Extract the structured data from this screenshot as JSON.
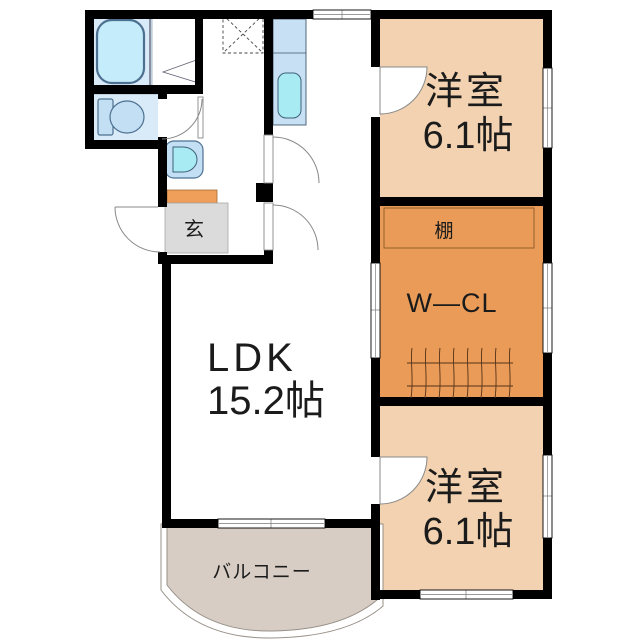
{
  "floorplan": {
    "rooms": {
      "ldk": {
        "name": "LDK",
        "area": "15.2帖"
      },
      "bedroom_top": {
        "name": "洋室",
        "area": "6.1帖"
      },
      "bedroom_bottom": {
        "name": "洋室",
        "area": "6.1帖"
      },
      "walk_in_closet": {
        "name": "W—CL"
      },
      "shelf": {
        "name": "棚"
      },
      "entrance": {
        "name": "玄"
      },
      "balcony": {
        "name": "バルコニー"
      }
    },
    "colors": {
      "wall": "#000000",
      "bedroom": "#F2D2B0",
      "closet": "#E99B57",
      "entrance_step": "#EF9F5A",
      "entrance_floor": "#DBDBDB",
      "balcony": "#D7CDC4",
      "wet_floor": "#D9EAF8",
      "tub": "#C5ECFA",
      "fixture": "#C3DFF3",
      "sink": "#A9EBF3",
      "counter": "#C8E0F4",
      "line": "#888888"
    }
  }
}
